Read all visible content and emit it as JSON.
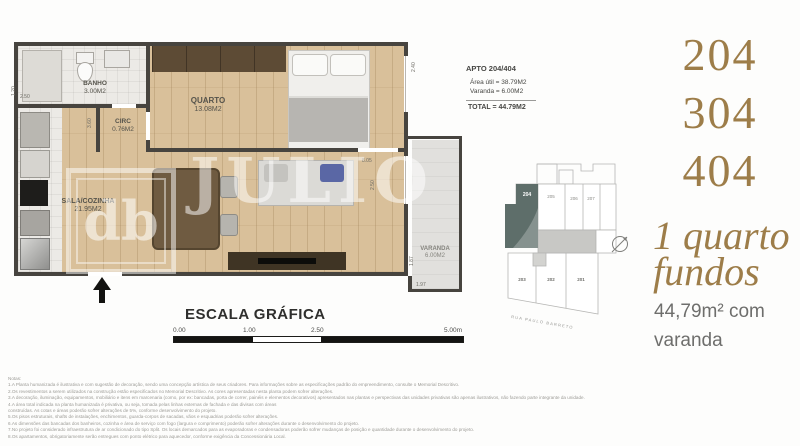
{
  "colors": {
    "gold": "#9d7d49",
    "wall": "#47443f",
    "highlight_unit": "#5e6e6a"
  },
  "watermark": {
    "text": "JULIO BOG",
    "logo": "db"
  },
  "plan": {
    "rooms": {
      "banho": {
        "name": "BANHO",
        "area": "3.00M2"
      },
      "circ": {
        "name": "CIRC",
        "area": "0.76M2"
      },
      "quarto": {
        "name": "QUARTO",
        "area": "13.08M2"
      },
      "sala": {
        "name": "SALA/COZINHA",
        "area": "21.95M2"
      },
      "varanda": {
        "name": "VARANDA",
        "area": "6.00M2"
      }
    },
    "dims": {
      "left_h": "2.50",
      "left_v": "1.20",
      "circ_v": "3.60",
      "quarto_v": "2.40",
      "sala_w": "8.05",
      "sala_v": "2.50",
      "varanda_v": "1.87",
      "varanda_h": "1.97"
    }
  },
  "info_box": {
    "title": "APTO 204/404",
    "area_util": "Área útil =  38.79M2",
    "varanda": "Varanda = 6.00M2",
    "total": "TOTAL =  44.79M2"
  },
  "scale_bar": {
    "title": "ESCALA GRÁFICA",
    "t0": "0.00",
    "t1": "1.00",
    "t2": "2.50",
    "t3": "5.00m"
  },
  "keyplan": {
    "u204": "204",
    "u205": "205",
    "u206": "206",
    "u207": "207",
    "u203": "203",
    "u202": "202",
    "u201": "201",
    "street": "RUA PAULO BARRETO"
  },
  "right_panel": {
    "unit1": "204",
    "unit2": "304",
    "unit3": "404",
    "tag1": "1 quarto",
    "tag2": "fundos",
    "size1": "44,79m² com",
    "size2": "varanda"
  },
  "notes": {
    "heading": "Notas:",
    "l1": "1.A Planta humanizada é ilustrativa e com sugestão de decoração, sendo uma concepção artística de seus criadores. Para informações sobre as especificações padrão do empreendimento, consulte o Memorial Descritivo.",
    "l2": "2.Os revestimentos a serem utilizados na construção estão especificados no Memorial Descritivo. As cores apresentadas nesta planta podem sofrer alterações.",
    "l3": "3.A decoração, iluminação, equipamentos, mobiliário e itens em marcenaria (como, por ex: bancadas, porta de correr, painéis e elementos decorativos) apresentados nas plantas e perspectivas das unidades privativas são apenas ilustrativos, não fazendo parte integrante da unidade.",
    "l4": "4.A área total indicada na planta humanizada é privativa, ou seja, tomada pelas linhas externas de fachada e das divisas com áreas",
    "l5": "construídas. As cotas e áreas poderão sofrer alterações de 5%, conforme desenvolvimento do projeto.",
    "l6": "5.Os pisos estruturais, shafts de instalações, enchimentos, guarda-corpos de sacadas, vãos e esquadrias poderão sofrer alterações.",
    "l7": "6.As dimensões das bancadas dos banheiros, cozinha e área de serviço com fogo (largura e comprimento) poderão sofrer alterações durante o desenvolvimento do projeto.",
    "l8": "7.No projeto foi considerado infraestrutura de ar condicionado do tipo Split. Os locais demarcados para as evaporadoras e condensadoras poderão sofrer mudanças de posição e quantidade durante o desenvolvimento do projeto.",
    "l9": "8.Os apartamentos, obrigatoriamente serão entregues com ponto elétrico para aquecedor, conforme exigência da Concessionária Local."
  }
}
